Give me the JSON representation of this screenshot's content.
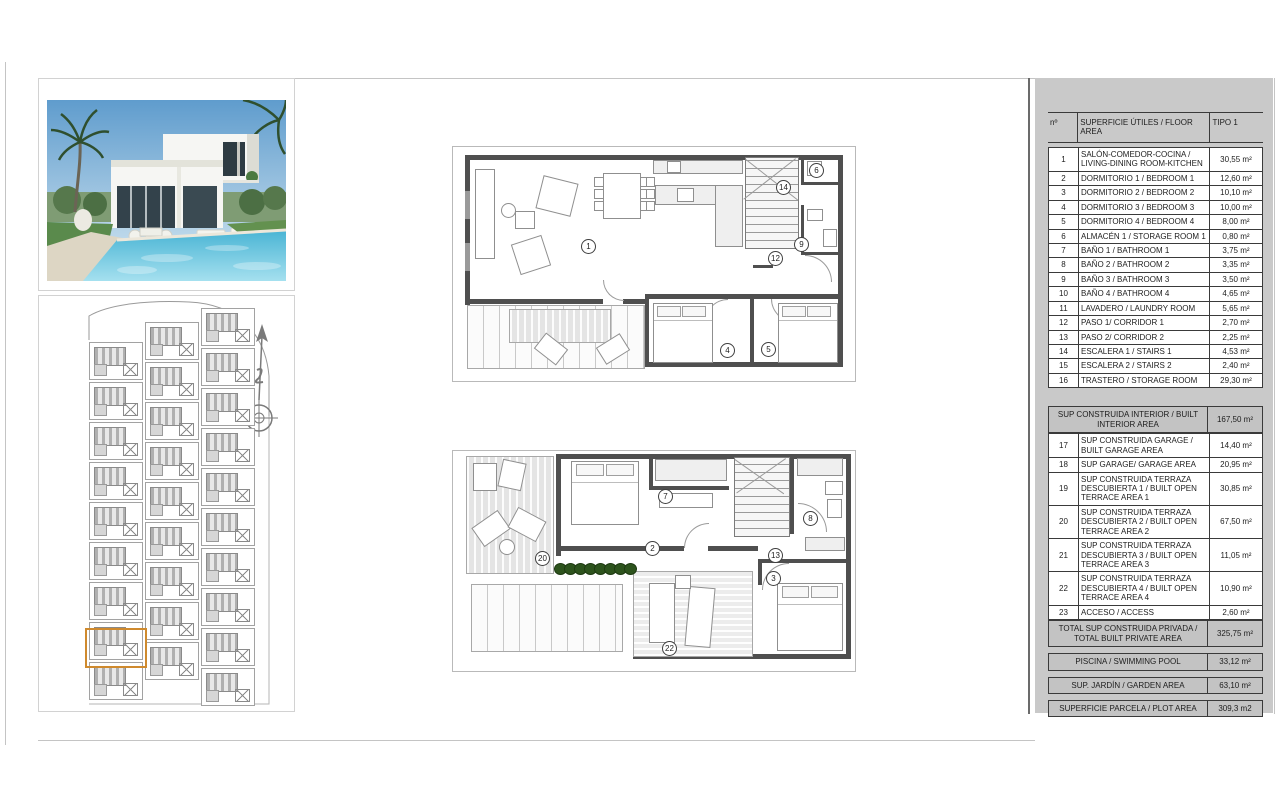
{
  "table": {
    "headers": {
      "num": "nº",
      "label": "SUPERFICIE ÚTILES / FLOOR AREA",
      "type": "TIPO 1"
    },
    "rows": [
      {
        "n": "1",
        "l": "SALÓN-COMEDOR-COCINA / LIVING-DINING ROOM-KITCHEN",
        "v": "30,55 m²"
      },
      {
        "n": "2",
        "l": "DORMITORIO 1 / BEDROOM 1",
        "v": "12,60 m²"
      },
      {
        "n": "3",
        "l": "DORMITORIO 2 / BEDROOM 2",
        "v": "10,10 m²"
      },
      {
        "n": "4",
        "l": "DORMITORIO 3 / BEDROOM 3",
        "v": "10,00 m²"
      },
      {
        "n": "5",
        "l": "DORMITORIO 4 / BEDROOM 4",
        "v": "8,00 m²"
      },
      {
        "n": "6",
        "l": "ALMACÉN 1 / STORAGE ROOM 1",
        "v": "0,80 m²"
      },
      {
        "n": "7",
        "l": "BAÑO 1 / BATHROOM 1",
        "v": "3,75 m²"
      },
      {
        "n": "8",
        "l": "BAÑO 2 / BATHROOM 2",
        "v": "3,35 m²"
      },
      {
        "n": "9",
        "l": "BAÑO 3 / BATHROOM 3",
        "v": "3,50 m²"
      },
      {
        "n": "10",
        "l": "BAÑO 4 / BATHROOM 4",
        "v": "4,65 m²"
      },
      {
        "n": "11",
        "l": "LAVADERO / LAUNDRY ROOM",
        "v": "5,65 m²"
      },
      {
        "n": "12",
        "l": "PASO 1/ CORRIDOR 1",
        "v": "2,70 m²"
      },
      {
        "n": "13",
        "l": "PASO 2/ CORRIDOR 2",
        "v": "2,25 m²"
      },
      {
        "n": "14",
        "l": "ESCALERA 1 / STAIRS 1",
        "v": "4,53 m²"
      },
      {
        "n": "15",
        "l": "ESCALERA 2 / STAIRS 2",
        "v": "2,40 m²"
      },
      {
        "n": "16",
        "l": "TRASTERO / STORAGE ROOM",
        "v": "29,30 m²"
      }
    ],
    "interior": {
      "label": "SUP CONSTRUIDA INTERIOR / BUILT INTERIOR AREA",
      "value": "167,50 m²"
    },
    "rows2": [
      {
        "n": "17",
        "l": "SUP CONSTRUIDA GARAGE / BUILT GARAGE AREA",
        "v": "14,40 m²"
      },
      {
        "n": "18",
        "l": "SUP GARAGE/ GARAGE AREA",
        "v": "20,95 m²"
      },
      {
        "n": "19",
        "l": "SUP CONSTRUIDA TERRAZA DESCUBIERTA 1 / BUILT OPEN TERRACE AREA 1",
        "v": "30,85 m²"
      },
      {
        "n": "20",
        "l": "SUP CONSTRUIDA TERRAZA DESCUBIERTA 2 / BUILT OPEN TERRACE AREA 2",
        "v": "67,50 m²"
      },
      {
        "n": "21",
        "l": "SUP CONSTRUIDA TERRAZA DESCUBIERTA 3 / BUILT OPEN TERRACE AREA 3",
        "v": "11,05 m²"
      },
      {
        "n": "22",
        "l": "SUP CONSTRUIDA TERRAZA DESCUBIERTA 4 / BUILT OPEN TERRACE AREA 4",
        "v": "10,90 m²"
      },
      {
        "n": "23",
        "l": "ACCESO / ACCESS",
        "v": "2,60 m²"
      }
    ],
    "total": {
      "label": "TOTAL SUP CONSTRUIDA PRIVADA / TOTAL BUILT PRIVATE AREA",
      "value": "325,75 m²"
    },
    "pool": {
      "label": "PISCINA / SWIMMING POOL",
      "value": "33,12 m²"
    },
    "garden": {
      "label": "SUP. JARDÍN / GARDEN AREA",
      "value": "63,10 m²"
    },
    "plot": {
      "label": "SUPERFICIE PARCELA / PLOT AREA",
      "value": "309,3 m2"
    }
  },
  "plans": {
    "upper": {
      "markers": [
        "1",
        "14",
        "6",
        "9",
        "12",
        "4",
        "5"
      ]
    },
    "lower": {
      "markers": [
        "20",
        "7",
        "2",
        "8",
        "13",
        "3",
        "22"
      ]
    }
  },
  "colors": {
    "panel_gray": "#c9c9c9",
    "wall_gray": "#4f4f4f",
    "highlight_orange": "#cf8a2e",
    "bush_green": "#2d531d",
    "pool_blue": "#2f9fc4"
  }
}
